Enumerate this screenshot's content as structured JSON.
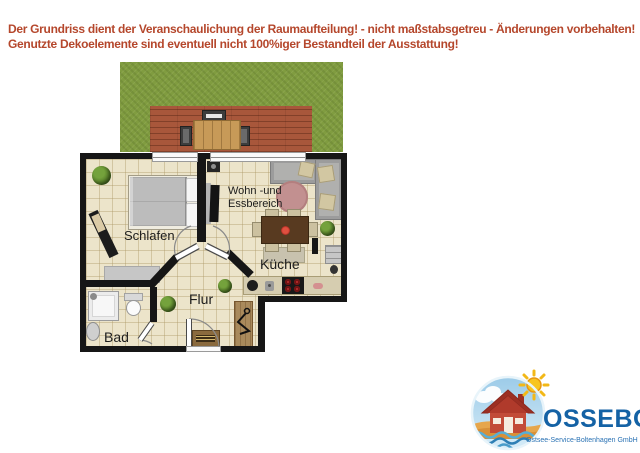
{
  "disclaimer": {
    "line1": "Der Grundriss dient der Veranschaulichung der Raumaufteilung! - nicht maßstabsgetreu - Änderungen vorbehalten!",
    "line2": "Genutzte Dekoelemente sind eventuell nicht 100%iger Bestandteil der Ausstattung!"
  },
  "floorplan": {
    "labels": {
      "schlafen": "Schlafen",
      "wohn_line1": "Wohn -und",
      "wohn_line2": "Essbereich",
      "kueche": "Küche",
      "flur": "Flur",
      "bad": "Bad"
    }
  },
  "logo": {
    "brand": "OSSEBO",
    "subtitle": "Ostsee-Service-Boltenhagen GmbH"
  },
  "icons": {
    "plant": "potted-plant",
    "hanger": "clothes-hanger",
    "sun": "sun",
    "cloud": "cloud",
    "house": "house",
    "waves": "sea-waves"
  },
  "colors": {
    "disclaimer_text": "#b5472c",
    "wall": "#161616",
    "floor_tile": "#ece4ca",
    "grass": "#809c40",
    "terrace_wood": "#a8573b",
    "rug_rose": "#c29090",
    "burner_red": "#c23030",
    "brand_blue": "#1462a5",
    "logo_sky": "#aed6ee",
    "logo_sand": "#e6a64c",
    "logo_house_red": "#c24b38"
  }
}
